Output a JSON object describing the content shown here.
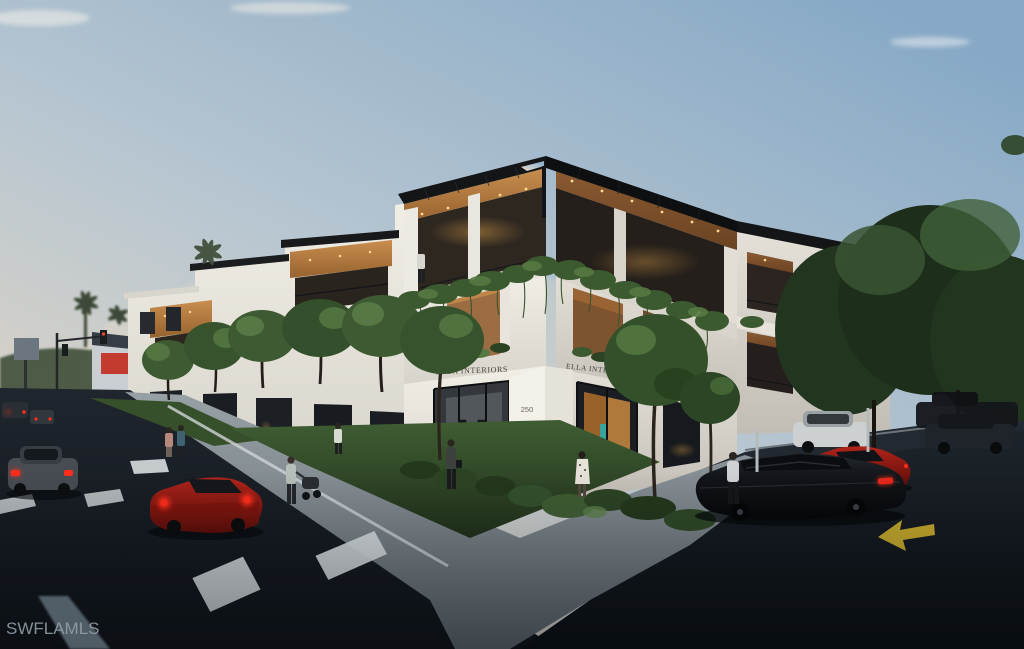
{
  "image": {
    "type": "architectural rendering photograph",
    "description": "Dusk rendering of a modern three-story corner mixed-use building with black rooftop pergola, warm lit wood ceilings, cascading balcony greenery, lit storefronts, street traffic on the left and a rear parking lot on the right",
    "watermark": "SWFLAMLS"
  },
  "building": {
    "sign_left": "ELLA INTERIORS",
    "sign_right": "ELLA INTERIORS",
    "address_number": "250",
    "storefront_artwork_letter": "M"
  },
  "colors": {
    "sky_top": "#87a9c6",
    "sky_mid": "#b7c6d1",
    "sky_horizon": "#e6d9c6",
    "facade_light": "#f1eee5",
    "facade_shade": "#cfccc3",
    "wood_light": "#c98e4f",
    "wood_shade": "#8a5a32",
    "pergola_black": "#131517",
    "glass_dark": "#1a1e22",
    "interior_glow": "#e8a84e",
    "green_light": "#567a43",
    "green_mid": "#3c5a30",
    "green_dark": "#263c1f",
    "lawn_green": "#3f5d33",
    "road_asphalt": "#20262e",
    "lot_asphalt": "#1d242b",
    "pavement_gray": "#98a1a6",
    "car_red": "#b0241a",
    "taillight_red": "#ff2d1c",
    "arrow_yellow": "#d4b42e",
    "watermark_gray": "#929ea8",
    "sign_text": "#46413a",
    "teal_accent": "#3aa39b",
    "distant_sign_red": "#c23b2e"
  }
}
